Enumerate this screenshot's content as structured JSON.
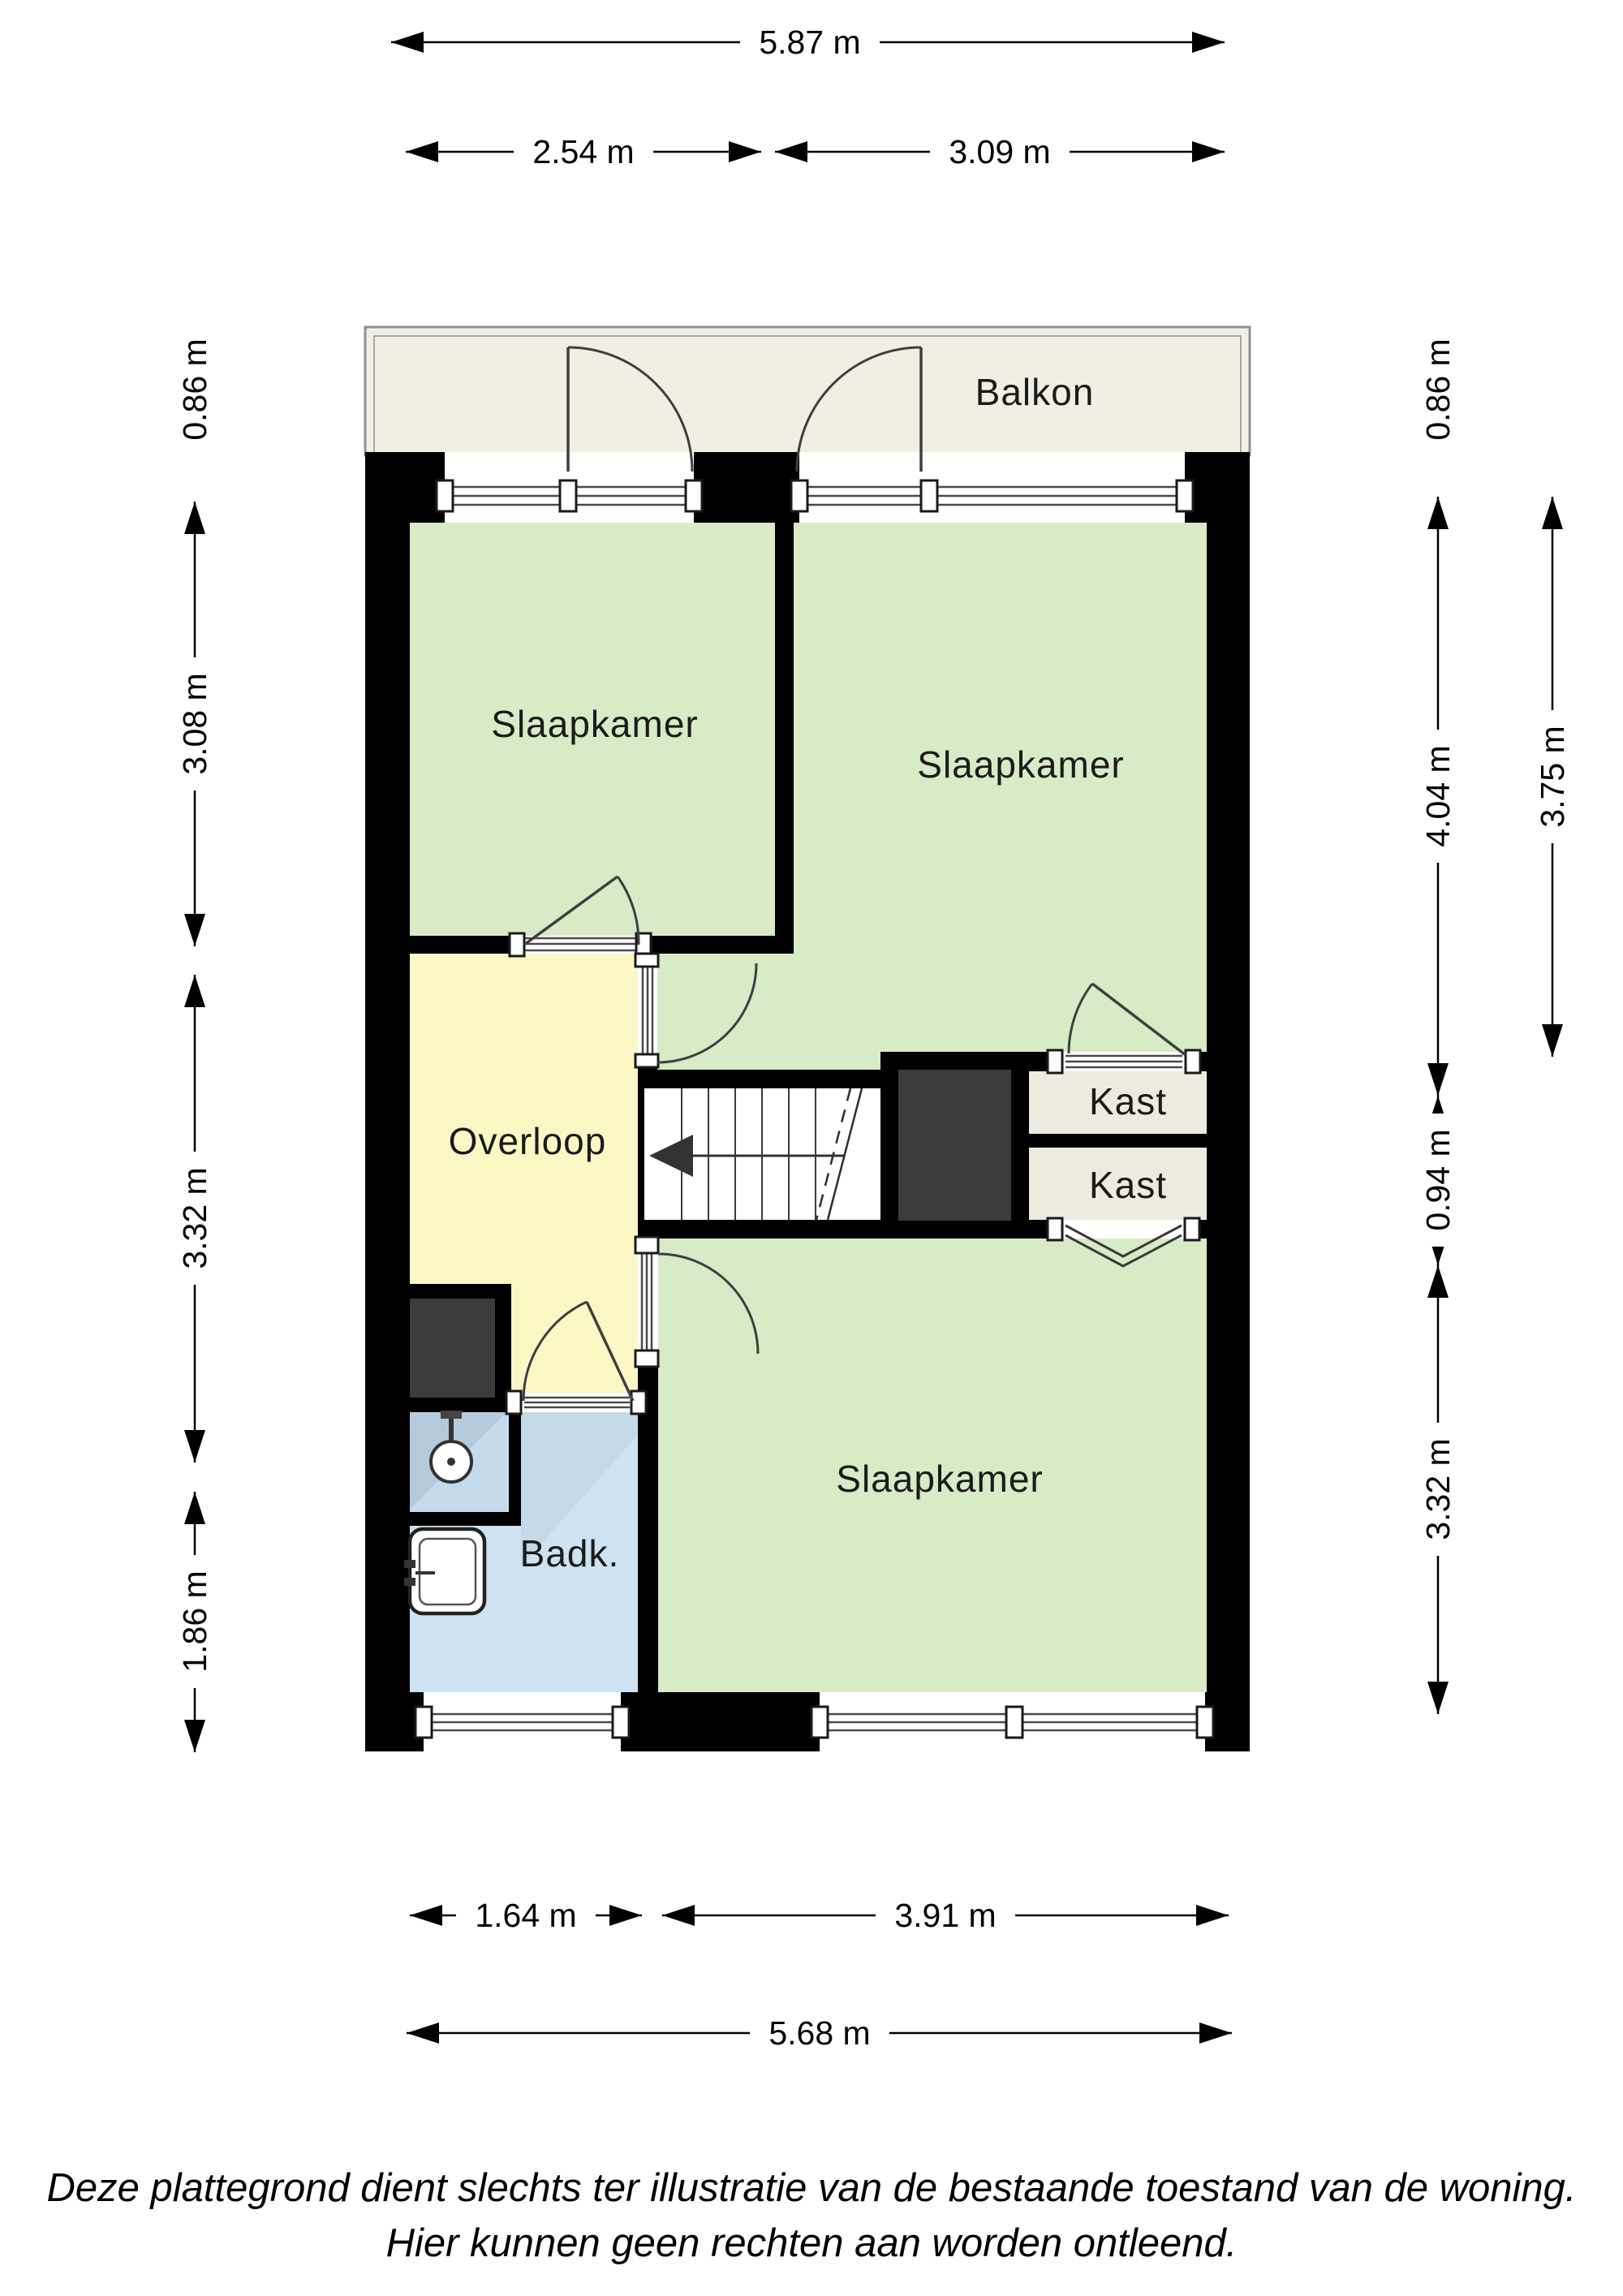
{
  "title": "Plattegrond verdieping",
  "rooms": {
    "balkon": {
      "label": "Balkon"
    },
    "slaapkamer_top_left": {
      "label": "Slaapkamer"
    },
    "slaapkamer_top_right": {
      "label": "Slaapkamer"
    },
    "overloop": {
      "label": "Overloop"
    },
    "kast_upper": {
      "label": "Kast"
    },
    "kast_lower": {
      "label": "Kast"
    },
    "slaapkamer_bottom": {
      "label": "Slaapkamer"
    },
    "badkamer": {
      "label": "Badk."
    }
  },
  "dimensions": {
    "top_total": "5.87 m",
    "top_left": "2.54 m",
    "top_right": "3.09 m",
    "left_balcony": "0.86 m",
    "left_upper": "3.08 m",
    "left_middle": "3.32 m",
    "left_lower": "1.86 m",
    "right_balcony": "0.86 m",
    "right_upper": "4.04 m",
    "right_outer": "3.75 m",
    "right_middle": "0.94 m",
    "right_lower": "3.32 m",
    "bottom_left": "1.64 m",
    "bottom_right": "3.91 m",
    "bottom_total": "5.68 m"
  },
  "disclaimer": {
    "line1": "Deze plattegrond dient slechts ter illustratie van de bestaande toestand van de woning.",
    "line2": "Hier kunnen geen rechten aan worden ontleend."
  },
  "colors": {
    "room_green": "#d7ebc6",
    "hall_yellow": "#fbf7c5",
    "bath_blue": "#cde3f2",
    "shower_blue": "#c3dbed",
    "balcony_beige": "#f1efe3",
    "closet_beige": "#edebe0",
    "shaft_gray": "#3c3c3c",
    "wall_black": "#000000",
    "stairs_white": "#ffffff"
  }
}
